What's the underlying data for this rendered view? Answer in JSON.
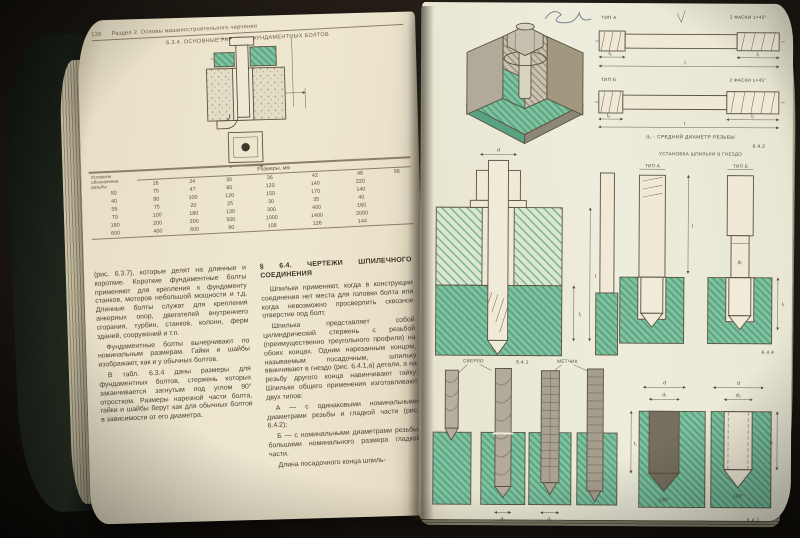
{
  "palette": {
    "page": "#efe8d1",
    "green_fill": "#83c3a2",
    "green_dark": "#5ea886",
    "ink": "#4c4233",
    "background": "#221c15"
  },
  "book": {
    "left_page": {
      "page_number": "136",
      "running_title": "Раздел 2. Основы машиностроительного черчения",
      "table_caption": "6.3.4. ОСНОВНЫЕ РАЗМЕРЫ ФУНДАМЕНТНЫХ БОЛТОВ",
      "table": {
        "units_header": "Размеры, мм",
        "stub_header": "Условное обозначение резьбы",
        "columns": [
          "16",
          "24",
          "30",
          "36",
          "42",
          "48",
          "56"
        ],
        "rows": [
          [
            "50",
            "75",
            "47",
            "80",
            "120",
            "140",
            "220"
          ],
          [
            "40",
            "80",
            "100",
            "120",
            "150",
            "170",
            "140"
          ],
          [
            "55",
            "75",
            "20",
            "25",
            "30",
            "35",
            "40"
          ],
          [
            "70",
            "100",
            "180",
            "130",
            "300",
            "400",
            "160"
          ],
          [
            "180",
            "200",
            "200",
            "500",
            "1000",
            "1400",
            "2000"
          ],
          [
            "600",
            "400",
            "600",
            "90",
            "108",
            "126",
            "144"
          ]
        ]
      },
      "column1_paragraphs": [
        "(рис. 6.3.7), которые делят на длинные и короткие. Короткие фундаментные болты применяют для крепления к фундаменту станков, моторов небольшой мощности и т.д. Длинные болты служат для крепления анкерных опор, двигателей внутреннего сгорания, турбин, станков, колонн, ферм зданий, сооружений и т.п.",
        "Фундаментные болты вычерчивают по номинальным размерам. Гайки и шайбы изображают, как и у обычных болтов.",
        "В табл. 6.3.4 даны размеры для фундаментных болтов, стержень которых заканчивается загнутым под углом 90° отростком. Размеры нарезной части болта, гайки и шайбы берут как для обычных болтов в зависимости от его диаметра."
      ],
      "column2": {
        "heading": "§ 6.4. ЧЕРТЕЖИ ШПИЛЕЧНОГО СОЕДИНЕНИЯ",
        "paragraphs": [
          "Шпильки применяют, когда в конструкции соединения нет места для головки болта или когда невозможно просверлить сквозное отверстие под болт.",
          "Шпилька представляет собой цилиндрический стержень с резьбой (преимущественно треугольного профиля) на обоих концах. Одним нарезанным концом, называемым посадочным, шпильку ввинчивают в гнездо (рис. 6.4.1,а) детали, а на резьбу другого конца навинчивают гайку. Шпильки общего применения изготавливают двух типов:",
          "А — с одинаковыми номинальными диаметрами резьбы и гладкой части (рис. 6.4.2);",
          "Б — с номинальными диаметрами резьбы, большими номинального размера гладкой части.",
          "Длина посадочного конца шпиль-"
        ]
      }
    },
    "right_page": {
      "fig_types": {
        "tip_a": "ТИП А",
        "tip_b": "ТИП Б",
        "note": "2 ФАСКИ 1×45°",
        "dim_l0": "l₀",
        "dim_l": "l",
        "dim_l1": "l₁",
        "dim_d": "d",
        "caption": "d₂ - СРЕДНИЙ ДИАМЕТР РЕЗЬБЫ",
        "number": "6.4.2"
      },
      "fig_assembly": {
        "number": "6.4.1",
        "dim_d": "d",
        "dim_l": "l",
        "dim_l1": "l₁"
      },
      "fig_install": {
        "heading": "УСТАНОВКА ШПИЛЬКИ В ГНЕЗДО",
        "tip_a": "ТИП А",
        "tip_b": "ТИП Б",
        "dim_l": "l",
        "dim_l1": "l₁",
        "dim_d2": "d₂",
        "number": "6.4.4"
      },
      "fig_tools": {
        "drill_label": "СВЕРЛО",
        "tap_label": "МЕТЧИК",
        "dim_d1": "d₁"
      },
      "fig_holes": {
        "dim_d": "d",
        "dim_d1": "d₁",
        "dim_d2": "d₂",
        "dim_l1": "l₁",
        "dim_l2": "l₂",
        "angle": "120°",
        "number": "6.4.3"
      }
    }
  }
}
